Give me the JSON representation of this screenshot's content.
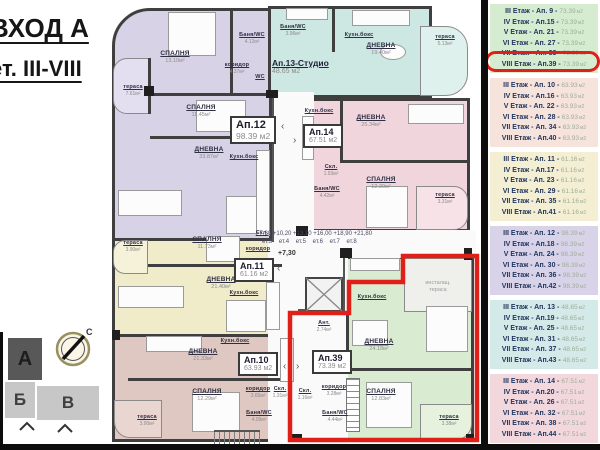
{
  "title": {
    "line1": "ВХОД А",
    "line2": "ет. III-VIII"
  },
  "plan": {
    "levels": {
      "line1": "+7,30 +10,20 +13,10 +16,00 +18,90 +21,80",
      "line2": "ет.3    ет.4    ет.5    ет.6    ет.7    ет.8",
      "current": "+7,30"
    },
    "annotations": {
      "service_terrace_line1": "инсталац.",
      "service_terrace_line2": "тераса"
    },
    "apartments": [
      {
        "id": "Ап.12",
        "area": "98.39",
        "unit": "м2",
        "color": "#d8d2e6",
        "rooms": [
          {
            "name": "СПАЛНЯ",
            "area": "13.10м²"
          },
          {
            "name": "тераса",
            "area": "7.61м²"
          },
          {
            "name": "коридор",
            "area": "4.37м²"
          },
          {
            "name": "Баня/WC",
            "area": "4.12м²"
          },
          {
            "name": "WC",
            "area": ""
          },
          {
            "name": "СПАЛНЯ",
            "area": "11.45м²"
          },
          {
            "name": "ДНЕВНА",
            "area": "33.87м²"
          },
          {
            "name": "Кухн.бокс",
            "area": ""
          }
        ]
      },
      {
        "id": "Ап.13-Студио",
        "area": "48.65",
        "unit": "м2",
        "color": "#cde7e2",
        "rooms": [
          {
            "name": "Баня/WC",
            "area": "3.96м²"
          },
          {
            "name": "Кухн.бокс",
            "area": ""
          },
          {
            "name": "ДНЕВНА",
            "area": "19.40м²"
          },
          {
            "name": "тераса",
            "area": "5.13м²"
          }
        ]
      },
      {
        "id": "Ап.14",
        "area": "67.51",
        "unit": "м2",
        "color": "#f1d5dc",
        "rooms": [
          {
            "name": "Кухн.бокс",
            "area": ""
          },
          {
            "name": "Скл.",
            "area": "1.93м²"
          },
          {
            "name": "Баня/WC",
            "area": "4.42м²"
          },
          {
            "name": "ДНЕВНА",
            "area": "25.34м²"
          },
          {
            "name": "СПАЛНЯ",
            "area": "12.30м²"
          },
          {
            "name": "тераса",
            "area": "3.31м²"
          }
        ]
      },
      {
        "id": "Ап.11",
        "area": "61.16",
        "unit": "м2",
        "color": "#f0ebc9",
        "rooms": [
          {
            "name": "тераса",
            "area": "3.90м²"
          },
          {
            "name": "СПАЛНЯ",
            "area": "11.73м²"
          },
          {
            "name": "коридор",
            "area": ""
          },
          {
            "name": "Скл.",
            "area": ""
          },
          {
            "name": "ДНЕВНА",
            "area": "21.40м²"
          },
          {
            "name": "Кухн.бокс",
            "area": ""
          }
        ]
      },
      {
        "id": "Ап.10",
        "area": "63.93",
        "unit": "м2",
        "color": "#dfc8c1",
        "rooms": [
          {
            "name": "ДНЕВНА",
            "area": "21.33м²"
          },
          {
            "name": "Кухн.бокс",
            "area": ""
          },
          {
            "name": "СПАЛНЯ",
            "area": "12.29м²"
          },
          {
            "name": "коридор",
            "area": "3.65м²"
          },
          {
            "name": "Скл.",
            "area": "1.31м²"
          },
          {
            "name": "Баня/WC",
            "area": "4.09м²"
          },
          {
            "name": "тераса",
            "area": "3.90м²"
          }
        ]
      },
      {
        "id": "Ап.39",
        "area": "73.39",
        "unit": "м2",
        "color": "#d9ecd1",
        "rooms": [
          {
            "name": "Кухн.бокс",
            "area": ""
          },
          {
            "name": "Ант.",
            "area": "2.74м²"
          },
          {
            "name": "ДНЕВНА",
            "area": "24.18м²"
          },
          {
            "name": "коридор",
            "area": "3.28м²"
          },
          {
            "name": "СПАЛНЯ",
            "area": "12.83м²"
          },
          {
            "name": "Баня/WC",
            "area": "4.44м²"
          },
          {
            "name": "Скл.",
            "area": "1.16м²"
          },
          {
            "name": "тераса",
            "area": "3.38м²"
          }
        ]
      }
    ]
  },
  "site_plan": {
    "blocks": [
      {
        "label": "А"
      },
      {
        "label": "Б"
      },
      {
        "label": "В"
      }
    ],
    "compass_north": "С"
  },
  "legend": {
    "unit": "м2",
    "highlight_color": "#e02018",
    "groups": [
      {
        "color": "#d6ecd0",
        "rows": [
          {
            "floor": "III Етаж",
            "apt": "Ап. 9",
            "area": "73.39"
          },
          {
            "floor": "IV Етаж",
            "apt": "Ап.15",
            "area": "73.39"
          },
          {
            "floor": "V Етаж",
            "apt": "Ап. 21",
            "area": "73.39"
          },
          {
            "floor": "VI Етаж",
            "apt": "Ап. 27",
            "area": "73.39"
          },
          {
            "floor": "VII Етаж",
            "apt": "Ап. 33",
            "area": "73.39"
          },
          {
            "floor": "VIII Етаж",
            "apt": "Ап.39",
            "area": "73.39",
            "highlighted": true
          }
        ]
      },
      {
        "color": "#f6e3dc",
        "rows": [
          {
            "floor": "III Етаж",
            "apt": "Ап. 10",
            "area": "63.93"
          },
          {
            "floor": "IV Етаж",
            "apt": "Ап.16",
            "area": "63.93"
          },
          {
            "floor": "V Етаж",
            "apt": "Ап. 22",
            "area": "63.93"
          },
          {
            "floor": "VI Етаж",
            "apt": "Ап. 28",
            "area": "63.93"
          },
          {
            "floor": "VII Етаж",
            "apt": "Ап. 34",
            "area": "63.93"
          },
          {
            "floor": "VIII Етаж",
            "apt": "Ап.40",
            "area": "63.93"
          }
        ]
      },
      {
        "color": "#f4efd3",
        "rows": [
          {
            "floor": "III Етаж",
            "apt": "Ап. 11",
            "area": "61.16"
          },
          {
            "floor": "IV Етаж",
            "apt": "Ап.17",
            "area": "61.16"
          },
          {
            "floor": "V Етаж",
            "apt": "Ап. 23",
            "area": "61.16"
          },
          {
            "floor": "VI Етаж",
            "apt": "Ап. 29",
            "area": "61.16"
          },
          {
            "floor": "VII Етаж",
            "apt": "Ап. 35",
            "area": "61.16"
          },
          {
            "floor": "VIII Етаж",
            "apt": "Ап.41",
            "area": "61.16"
          }
        ]
      },
      {
        "color": "#d9d3e9",
        "rows": [
          {
            "floor": "III Етаж",
            "apt": "Ап. 12",
            "area": "98.39"
          },
          {
            "floor": "IV Етаж",
            "apt": "Ап.18",
            "area": "98.39"
          },
          {
            "floor": "V Етаж",
            "apt": "Ап. 24",
            "area": "98.39"
          },
          {
            "floor": "VI Етаж",
            "apt": "Ап. 30",
            "area": "98.39"
          },
          {
            "floor": "VII Етаж",
            "apt": "Ап. 36",
            "area": "98.39"
          },
          {
            "floor": "VIII Етаж",
            "apt": "Ап.42",
            "area": "98.39"
          }
        ]
      },
      {
        "color": "#d4eae8",
        "rows": [
          {
            "floor": "III Етаж",
            "apt": "Ап. 13",
            "area": "48.65"
          },
          {
            "floor": "IV Етаж",
            "apt": "Ап.19",
            "area": "48.65"
          },
          {
            "floor": "V Етаж",
            "apt": "Ап. 25",
            "area": "48.65"
          },
          {
            "floor": "VI Етаж",
            "apt": "Ап. 31",
            "area": "48.65"
          },
          {
            "floor": "VII Етаж",
            "apt": "Ап. 37",
            "area": "48.65"
          },
          {
            "floor": "VIII Етаж",
            "apt": "Ап.43",
            "area": "48.65"
          }
        ]
      },
      {
        "color": "#f2d7dd",
        "rows": [
          {
            "floor": "III Етаж",
            "apt": "Ап. 14",
            "area": "67.51"
          },
          {
            "floor": "IV Етаж",
            "apt": "Ап.20",
            "area": "67.51"
          },
          {
            "floor": "V Етаж",
            "apt": "Ап. 26",
            "area": "67.51"
          },
          {
            "floor": "VI Етаж",
            "apt": "Ап. 32",
            "area": "67.51"
          },
          {
            "floor": "VII Етаж",
            "apt": "Ап. 38",
            "area": "67.51"
          },
          {
            "floor": "VIII Етаж",
            "apt": "Ап.44",
            "area": "67.51"
          }
        ]
      }
    ]
  }
}
